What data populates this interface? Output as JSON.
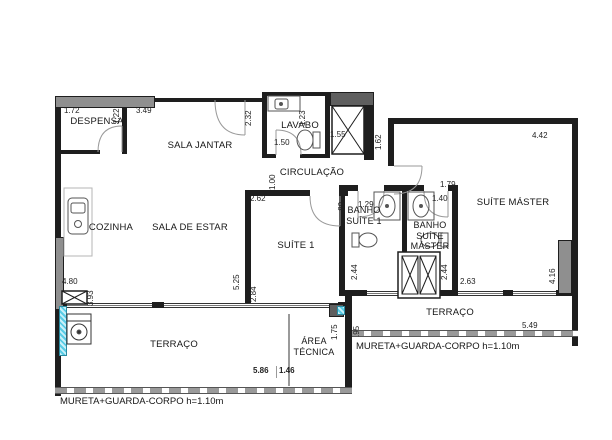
{
  "rooms": [
    {
      "label": "DESPENSA"
    },
    {
      "label": "SALA JANTAR"
    },
    {
      "label": "LAVABO"
    },
    {
      "label": "CIRCULAÇÃO"
    },
    {
      "label": "COZINHA"
    },
    {
      "label": "SALA DE ESTAR"
    },
    {
      "label": "SUÍTE 1"
    },
    {
      "label": "BANHO SUÍTE 1"
    },
    {
      "label": "BANHO SUÍTE MÁSTER"
    },
    {
      "label": "SUÍTE MÁSTER"
    },
    {
      "label": "TERRAÇO"
    },
    {
      "label": "ÁREA TÉCNICA"
    },
    {
      "label": "TERRAÇO"
    }
  ],
  "notes": [
    {
      "label": "MURETA+GUARDA-CORPO h=1.10m"
    },
    {
      "label": "MURETA+GUARDA-CORPO h=1.10m"
    }
  ],
  "dims": [
    {
      "v": "1.72"
    },
    {
      "v": "1.22"
    },
    {
      "v": "3.49"
    },
    {
      "v": "2.32"
    },
    {
      "v": "1.50"
    },
    {
      "v": "1.23"
    },
    {
      "v": "1.55"
    },
    {
      "v": "1.62"
    },
    {
      "v": "4.42"
    },
    {
      "v": "1.00"
    },
    {
      "v": "2.62"
    },
    {
      "v": "1.29"
    },
    {
      "v": "1.79"
    },
    {
      "v": "1.40"
    },
    {
      "v": ".89"
    },
    {
      "v": "5.25"
    },
    {
      "v": "2.84"
    },
    {
      "v": "2.44"
    },
    {
      "v": "2.44"
    },
    {
      "v": "2.63"
    },
    {
      "v": "4.80"
    },
    {
      "v": "3.93"
    },
    {
      "v": "1.75"
    },
    {
      "v": ".95"
    },
    {
      "v": "5.86"
    },
    {
      "v": "1.46"
    },
    {
      "v": "5.49"
    },
    {
      "v": "4.16"
    }
  ],
  "colors": {
    "wall": "#1e1e1e",
    "pillar": "#8f8f8f",
    "glass": "#58cce6"
  }
}
